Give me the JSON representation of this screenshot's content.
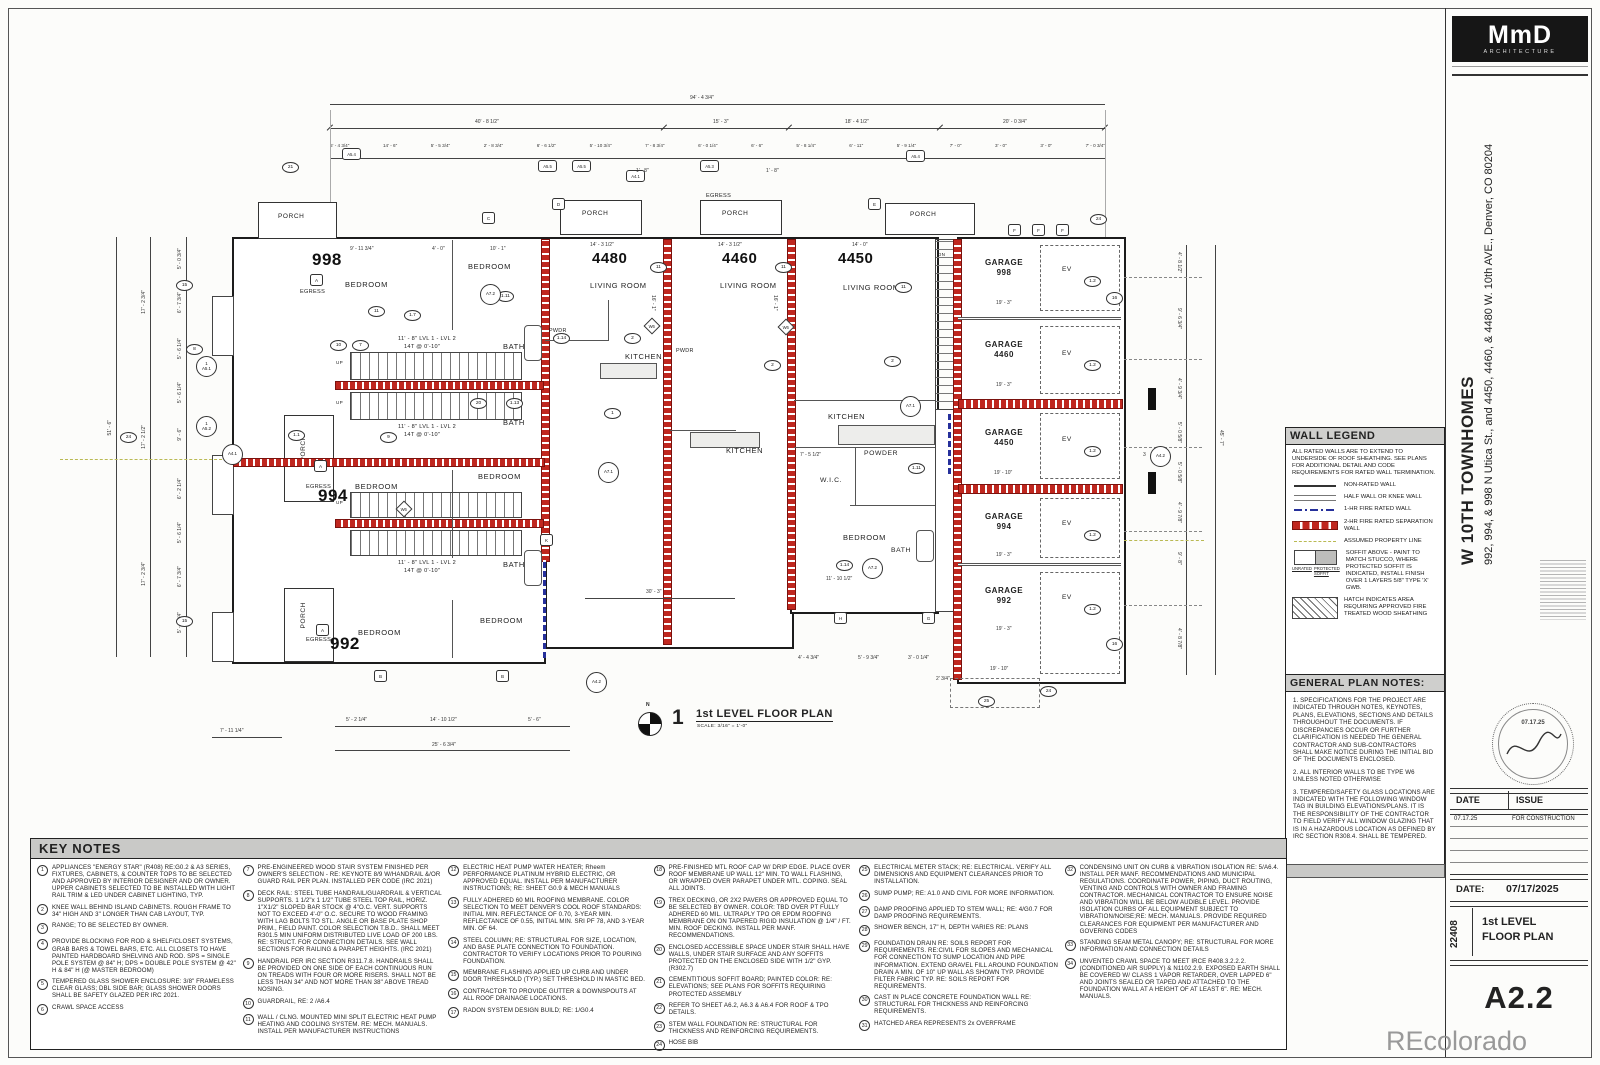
{
  "sheet": {
    "watermark": "REcolorado"
  },
  "titleblock": {
    "logo_main": "MmD",
    "logo_sub": "ARCHITECTURE",
    "project_name": "W 10TH TOWNHOMES",
    "project_address1": "992, 994, & 998 N Utica St., and 4450, 4460, & 4480 W. 10th AVE.,",
    "project_address2": "Denver, CO 80204",
    "stamp_date": "07.17.25",
    "issue": {
      "date_h": "DATE",
      "issue_h": "ISSUE",
      "row_date": "07.17.25",
      "row_issue": "FOR CONSTRUCTION"
    },
    "date_label": "DATE:",
    "date_value": "07/17/2025",
    "project_number": "22408",
    "sheet_title1": "1st LEVEL",
    "sheet_title2": "FLOOR PLAN",
    "sheet_number": "A2.2"
  },
  "wall_legend": {
    "title": "WALL LEGEND",
    "intro": "ALL RATED WALLS ARE TO EXTEND TO UNDERSIDE OF ROOF SHEATHING.  SEE PLANS FOR ADDITIONAL DETAIL AND CODE REQUIREMENTS FOR RATED WALL TERMINATION.",
    "rows": [
      {
        "label": "NON-RATED WALL"
      },
      {
        "label": "HALF WALL OR KNEE WALL"
      },
      {
        "label": "1-HR FIRE RATED WALL"
      },
      {
        "label": "2-HR FIRE RATED SEPARATION WALL"
      },
      {
        "label": "ASSUMED PROPERTY LINE"
      },
      {
        "label": "SOFFIT ABOVE - PAINT TO MATCH STUCCO, WHERE PROTECTED SOFFIT IS INDICATED, INSTALL FINISH OVER 1 LAYERS 5/8\" TYPE 'X' GWB."
      },
      {
        "label": "HATCH INDICATES AREA REQUIRING APPROVED FIRE TREATED WOOD SHEATHING"
      }
    ],
    "soffit_sub1": "UNRATED",
    "soffit_sub2": "PROTECTED SOFFIT"
  },
  "general_notes": {
    "title": "GENERAL PLAN NOTES:",
    "n1": "1. SPECIFICATIONS FOR THE PROJECT ARE INDICATED THROUGH NOTES, KEYNOTES, PLANS, ELEVATIONS, SECTIONS AND DETAILS THROUGHOUT THE DOCUMENTS.  IF DISCREPANCIES OCCUR OR FURTHER CLARIFICATION IS NEEDED THE GENERAL CONTRACTOR AND SUB-CONTRACTORS SHALL MAKE NOTICE DURING THE INITIAL BID OF THE DOCUMENTS ENCLOSED.",
    "n2": "2.  ALL INTERIOR WALLS TO BE TYPE W6 UNLESS NOTED OTHERWISE",
    "n3": "3.  TEMPERED/SAFETY GLASS LOCATIONS ARE INDICATED WITH THE FOLLOWING WINDOW TAG IN BUILDING ELEVATIONS/PLANS. IT IS THE RESPONSIBILITY OF THE CONTRACTOR TO FIELD VERIFY ALL WINDOW GLAZING THAT IS IN A HAZARDOUS LOCATION AS DEFINED BY IRC SECTION R308.4. SHALL BE TEMPERED."
  },
  "key_notes": {
    "title": "KEY NOTES",
    "items": [
      {
        "n": "1",
        "t": "APPLIANCES \"ENERGY STAR\" (R408) RE:G0.2 & A3 SERIES, FIXTURES, CABINETS, & COUNTER TOPS TO BE SELECTED AND APPROVED BY INTERIOR DESIGNER AND OR OWNER. UPPER CABINETS SELECTED TO BE INSTALLED WITH LIGHT RAIL TRIM & LED UNDER CABINET LIGHTING, TYP."
      },
      {
        "n": "2",
        "t": "KNEE WALL BEHIND ISLAND CABINETS. ROUGH FRAME TO 34\" HIGH AND 3\" LONGER THAN CAB LAYOUT, TYP."
      },
      {
        "n": "3",
        "t": "RANGE; TO BE SELECTED BY OWNER."
      },
      {
        "n": "4",
        "t": "PROVIDE BLOCKING FOR ROD & SHELF/CLOSET SYSTEMS, GRAB BARS & TOWEL BARS, ETC.  ALL CLOSETS TO HAVE PAINTED HARDBOARD SHELVING AND ROD.  SPS = SINGLE POLE SYSTEM @ 84\" H;  DPS = DOUBLE POLE SYSTEM @ 42\" H & 84\" H (@ MASTER BEDROOM)"
      },
      {
        "n": "5",
        "t": "TEMPERED GLASS SHOWER ENCLOSURE: 3/8\" FRAMELESS CLEAR GLASS; DBL SIDE BAR; GLASS SHOWER DOORS SHALL BE SAFETY GLAZED PER IRC 2021."
      },
      {
        "n": "6",
        "t": "CRAWL SPACE ACCESS"
      },
      {
        "n": "7",
        "t": "PRE-ENGINEERED WOOD STAIR SYSTEM FINISHED PER OWNER'S SELECTION - RE: KEYNOTE 8/9 W/HANDRAIL &/OR GUARD RAIL PER PLAN. INSTALLED PER CODE (IRC 2021)"
      },
      {
        "n": "8",
        "t": "DECK RAIL: STEEL TUBE HANDRAIL/GUARDRAIL & VERTICAL SUPPORTS. 1 1/2\"x 1 1/2\" TUBE STEEL TOP RAIL, HORIZ. 1\"X1/2\" SLOPED BAR STOCK @ 4\"O.C. VERT. SUPPORTS NOT TO EXCEED 4'-0\" O.C. SECURE TO WOOD FRAMING WITH LAG BOLTS TO STL. ANGLE OR BASE PLATE SHOP PRIM., FIELD PAINT. COLOR SELECTION T.B.D.. SHALL MEET R301.5 MIN UNIFORM DISTRIBUTED LIVE LOAD OF 200 LBS. RE: STRUCT. FOR CONNECTION DETAILS. SEE WALL SECTIONS FOR RAILING & PARAPET HEIGHTS. (IRC 2021)"
      },
      {
        "n": "9",
        "t": "HANDRAIL PER IRC SECTION R311.7.8. HANDRAILS SHALL BE PROVIDED ON ONE SIDE OF EACH CONTINUOUS RUN ON TREADS WITH FOUR OR MORE RISERS. SHALL NOT BE LESS THAN 34\" AND NOT MORE THAN 38\" ABOVE TREAD NOSING."
      },
      {
        "n": "10",
        "t": "GUARDRAIL, RE: 2 /A6.4"
      },
      {
        "n": "11",
        "t": "WALL / CLNG. MOUNTED MINI SPLIT ELECTRIC HEAT PUMP HEATING AND COOLING SYSTEM. RE: MECH. MANUALS. INSTALL PER MANUFACTURER INSTRUCTIONS"
      },
      {
        "n": "12",
        "t": "ELECTRIC HEAT PUMP WATER HEATER; Rheem PERFORMANCE PLATINUM HYBRID ELECTRIC, OR APPROVED EQUAL. INSTALL PER MANUFACTURER INSTRUCTIONS; RE: SHEET G0.9 & MECH MANUALS"
      },
      {
        "n": "13",
        "t": "FULLY ADHERED 60 MIL ROOFING MEMBRANE. COLOR SELECTION TO MEET DENVER'S COOL ROOF STANDARDS: INITIAL MIN. REFLECTANCE OF 0.70, 3-YEAR MIN. REFLECTANCE OF 0.55, INITIAL MIN. SRI PF 78, AND 3-YEAR MIN. OF 64."
      },
      {
        "n": "14",
        "t": "STEEL COLUMN; RE: STRUCTURAL FOR SIZE, LOCATION, AND BASE PLATE CONNECTION TO FOUNDATION. CONTRACTOR TO VERIFY LOCATIONS PRIOR TO POURING FOUNDATION."
      },
      {
        "n": "15",
        "t": "MEMBRANE FLASHING APPLIED UP CURB AND UNDER DOOR THRESHOLD (TYP.) SET THRESHOLD IN MASTIC BED."
      },
      {
        "n": "16",
        "t": "CONTRACTOR TO PROVIDE GUTTER & DOWNSPOUTS AT ALL ROOF DRAINAGE LOCATIONS."
      },
      {
        "n": "17",
        "t": "RADON SYSTEM DESIGN BUILD; RE: 1/G0.4"
      },
      {
        "n": "18",
        "t": "PRE-FINISHED MTL ROOF CAP W/ DRIP EDGE. PLACE OVER ROOF MEMBRANE UP WALL 12\" MIN. TO WALL FLASHING, OR WRAPPED OVER PARAPET UNDER MTL. COPING. SEAL ALL JOINTS."
      },
      {
        "n": "19",
        "t": "TREX DECKING, OR 2X2 PAVERS OR APPROVED EQUAL TO BE SELECTED BY OWNER. COLOR: TBD OVER PT FULLY ADHERED 60 MIL. ULTRAPLY TPO OR EPDM ROOFING MEMBRANE ON ON TAPERED RIGID INSULATION @ 1/4\" / FT. MIN. ROOF DECKING. INSTALL PER MANF. RECOMMENDATIONS."
      },
      {
        "n": "20",
        "t": "ENCLOSED ACCESSIBLE SPACE UNDER STAIR SHALL HAVE WALLS, UNDER STAIR SURFACE AND ANY SOFFITS PROTECTED ON THE ENCLOSED SIDE WITH 1/2\" GYP. (R302.7)"
      },
      {
        "n": "21",
        "t": "CEMENTITIOUS SOFFIT BOARD; PAINTED COLOR: RE: ELEVATIONS; SEE PLANS FOR SOFFITS REQUIRING PROTECTED ASSEMBLY"
      },
      {
        "n": "22",
        "t": "REFER TO SHEET A6.2, A6.3 & A6.4 FOR ROOF & TPO DETAILS."
      },
      {
        "n": "23",
        "t": "STEM WALL FOUNDATION RE: STRUCTURAL FOR THICKNESS AND REINFORCING REQUIREMENTS."
      },
      {
        "n": "24",
        "t": "HOSE BIB"
      },
      {
        "n": "25",
        "t": "ELECTRICAL METER STACK; RE: ELECTRICAL. VERIFY ALL DIMENSIONS AND EQUIPMENT CLEARANCES PRIOR TO INSTALLATION."
      },
      {
        "n": "26",
        "t": "SUMP PUMP; RE: A1.0 AND CIVIL FOR MORE INFORMATION."
      },
      {
        "n": "27",
        "t": "DAMP PROOFING APPLIED TO STEM WALL; RE: 4/G0.7 FOR DAMP PROOFING REQUIREMENTS."
      },
      {
        "n": "28",
        "t": "SHOWER BENCH, 17\" H, DEPTH VARIES RE: PLANS"
      },
      {
        "n": "29",
        "t": "FOUNDATION DRAIN RE: SOILS REPORT FOR REQUIREMENTS. RE:CIVIL FOR SLOPES AND MECHANICAL FOR CONNECTION TO SUMP LOCATION AND PIPE INFORMATION. EXTEND GRAVEL FILL AROUND FOUNDATION DRAIN A MIN. OF 10\" UP WALL AS SHOWN TYP. PROVIDE FILTER FABRIC TYP. RE: SOILS REPORT FOR REQUIREMENTS."
      },
      {
        "n": "30",
        "t": "CAST IN PLACE CONCRETE FOUNDATION WALL RE: STRUCTURAL FOR THICKNESS AND REINFORCING REQUIREMENTS."
      },
      {
        "n": "31",
        "t": "HATCHED AREA REPRESENTS 2x OVERFRAME"
      },
      {
        "n": "32",
        "t": "CONDENSING UNIT ON CURB & VIBRATION ISOLATION RE: 5/A6.4. INSTALL PER MANF. RECOMMENDATIONS AND MUNICIPAL REGULATIONS. COORDINATE POWER, PIPING, DUCT ROUTING, VENTING AND CONTROLS WITH OWNER AND FRAMING CONTRACTOR. MECHANICAL CONTRACTOR TO ENSURE NOISE AND VIBRATION WILL BE BELOW AUDIBLE LEVEL. PROVIDE ISOLATION CURBS OF ALL EQUIPMENT SUBJECT TO VIBRATION/NOISE;RE: MECH. MANUALS. PROVIDE REQUIRED CLEARANCES FOR EQUIPMENT PER MANUFACTURER AND GOVERING CODES"
      },
      {
        "n": "33",
        "t": "STANDING SEAM METAL CANOPY; RE: STRUCTURAL FOR MORE INFORMATION AND CONNECTION DETAILS"
      },
      {
        "n": "34",
        "t": "UNVENTED CRAWL SPACE TO MEET IRCE R408.3.2.2.2. (CONDITIONED AIR SUPPLY) & N1102.2.9. EXPOSED EARTH SHALL BE COVERED W/ CLASS 1 VAPOR RETARDER, OVER LAPPED 6\" AND JOINTS SEALED OR TAPED AND ATTACHED TO THE FOUNDATION WALL AT A HEIGHT OF AT LEAST 6\". RE: MECH. MANUALS."
      }
    ]
  },
  "plan": {
    "view": {
      "num": "1",
      "title": "1st LEVEL FLOOR PLAN",
      "scale": "SCALE:  3/16\" = 1'-0\"",
      "north": "N"
    },
    "units": {
      "u998": "998",
      "u994": "994",
      "u992": "992",
      "u4480": "4480",
      "u4460": "4460",
      "u4450": "4450"
    },
    "lbl": {
      "bedroom": "BEDROOM",
      "living": "LIVING ROOM",
      "kitchen": "KITCHEN",
      "bath": "BATH",
      "powder": "POWDER",
      "pwdr": "PWDR",
      "wic": "W.I.C.",
      "porch": "PORCH",
      "egress": "EGRESS",
      "garage": "GARAGE",
      "ev": "EV",
      "up": "UP",
      "dn": "DN"
    },
    "garage": {
      "n998": "998",
      "n4460": "4460",
      "n4450": "4450",
      "n994": "994",
      "n992": "992",
      "s193": "19' - 3\"",
      "s1910": "19' - 10\""
    },
    "stairs": {
      "lvl": "11' - 8\" LVL 1 - LVL 2",
      "tr": "14T @ 0'-10\""
    },
    "tags": {
      "a51": "A5.1",
      "a52": "A5.2",
      "a41": "A4.1",
      "a42": "A4.2",
      "a54": "A5.4",
      "a55": "A5.5",
      "a53": "A5.3",
      "a71": "A7.1",
      "a72": "A7.2",
      "w6": "W6",
      "t12": "1.2",
      "k1": "1",
      "k2": "2",
      "k3": "3",
      "k7": "7",
      "k8": "8",
      "k9": "9",
      "k10": "10",
      "k11": "11",
      "k15": "15",
      "k16": "16",
      "k20": "20",
      "k21": "21",
      "k24": "24",
      "k25": "25",
      "t17": "1.7",
      "t111": "1.11",
      "t113": "1.13",
      "t114": "1.14",
      "t11": "1.1",
      "a": "A",
      "b": "B",
      "c": "C",
      "d": "D",
      "e": "E",
      "f": "F",
      "g": "G",
      "h": "H",
      "k": "K"
    },
    "dims": {
      "top_total": "94' - 4 3/4\"",
      "top_seg": [
        "40' - 8 1/2\"",
        "15' - 3\"",
        "18' - 4 1/2\"",
        "20' - 0 3/4\""
      ],
      "top_small": [
        "5' - 4 3/4\"",
        "14' - 6\"",
        "5' - 5 3/4\"",
        "2' - 8 3/4\"",
        "6' - 6 1/2\"",
        "5' - 10 3/4\"",
        "7' - 8 3/4\"",
        "6' - 0 1/4\"",
        "6' - 6\"",
        "5' - 8 1/4\"",
        "6' - 11\"",
        "5' - 9 1/4\"",
        "7' - 0\"",
        "3' - 0\"",
        "3' - 0\"",
        "7' - 0 3/4\""
      ],
      "left_total": "51' - 6\"",
      "left_seg": [
        "17' - 2 3/4\"",
        "17' - 2 1/2\"",
        "17' - 2 3/4\""
      ],
      "left_small": [
        "5' - 0 3/4\"",
        "6' - 7 3/4\"",
        "5' - 6 1/4\"",
        "5' - 6 1/4\"",
        "9' - 6\"",
        "6' - 2 1/4\"",
        "5' - 6 1/4\"",
        "6' - 7 3/4\"",
        "5' - 0 3/4\""
      ],
      "right_total": "45' - 7\"",
      "right_small": [
        "4' - 8 1/2\"",
        "9' - 6 3/4\"",
        "4' - 9 3/4\"",
        "5' - 0 5/8\"",
        "5' - 0 5/8\"",
        "4' - 9 7/8\"",
        "9' - 8\"",
        "4' - 8 7/8\""
      ],
      "b711": "7' - 11 1/4\"",
      "b52": "5' - 2 1/4\"",
      "b1410": "14' - 10 1/2\"",
      "b56": "5' - 6\"",
      "b256": "25' - 6 3/4\"",
      "d30": "30' - 3\"",
      "g44": "4' - 4 3/4\"",
      "g59": "5' - 9 3/4\"",
      "g30": "3' - 0 1/4\"",
      "g23": "2' 3/4\"",
      "g1910": "19' - 10\"",
      "r1": "14' - 3 1/2\"",
      "r2": "14' - 0\"",
      "r3": "9' - 11 3/4\"",
      "r4": "10' - 1\"",
      "r5": "4' - 0\"",
      "r6": "11' - 10 1/2\"",
      "r7": "7' - 5 1/2\"",
      "r8": "1' - 8\"",
      "r9": "16' - 1\""
    }
  }
}
